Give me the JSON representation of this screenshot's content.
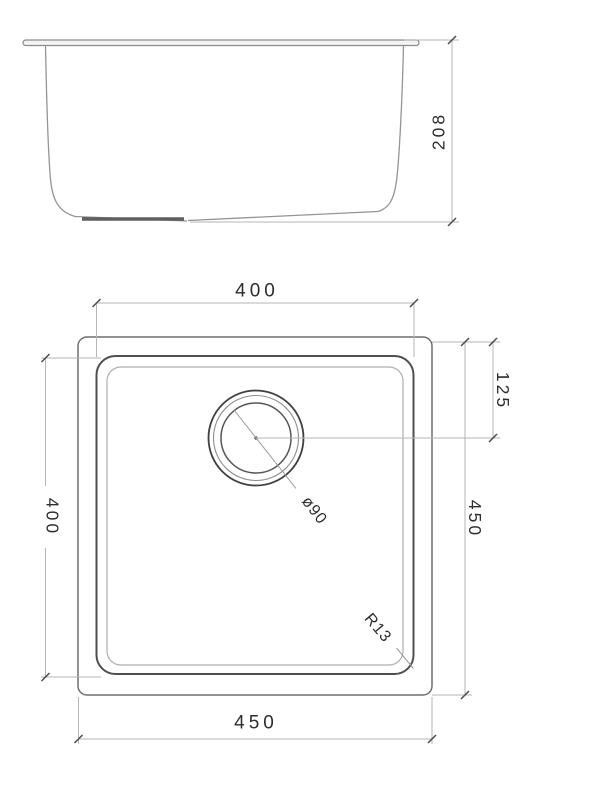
{
  "side_view": {
    "depth_label": "208"
  },
  "plan_view": {
    "bowl_width_label": "400",
    "bowl_depth_label": "400",
    "overall_width_label": "450",
    "overall_depth_label": "450",
    "drain_offset_label": "125",
    "drain_diameter_label": "ø90",
    "corner_radius_label": "R13"
  },
  "colors": {
    "background": "#ffffff",
    "outline_dark": "#4f4f4f",
    "outline_medium": "#6f6f6f",
    "outline_light": "#aeaeae",
    "dimension_line": "#b6b6b6",
    "text": "#2d2d2d"
  }
}
